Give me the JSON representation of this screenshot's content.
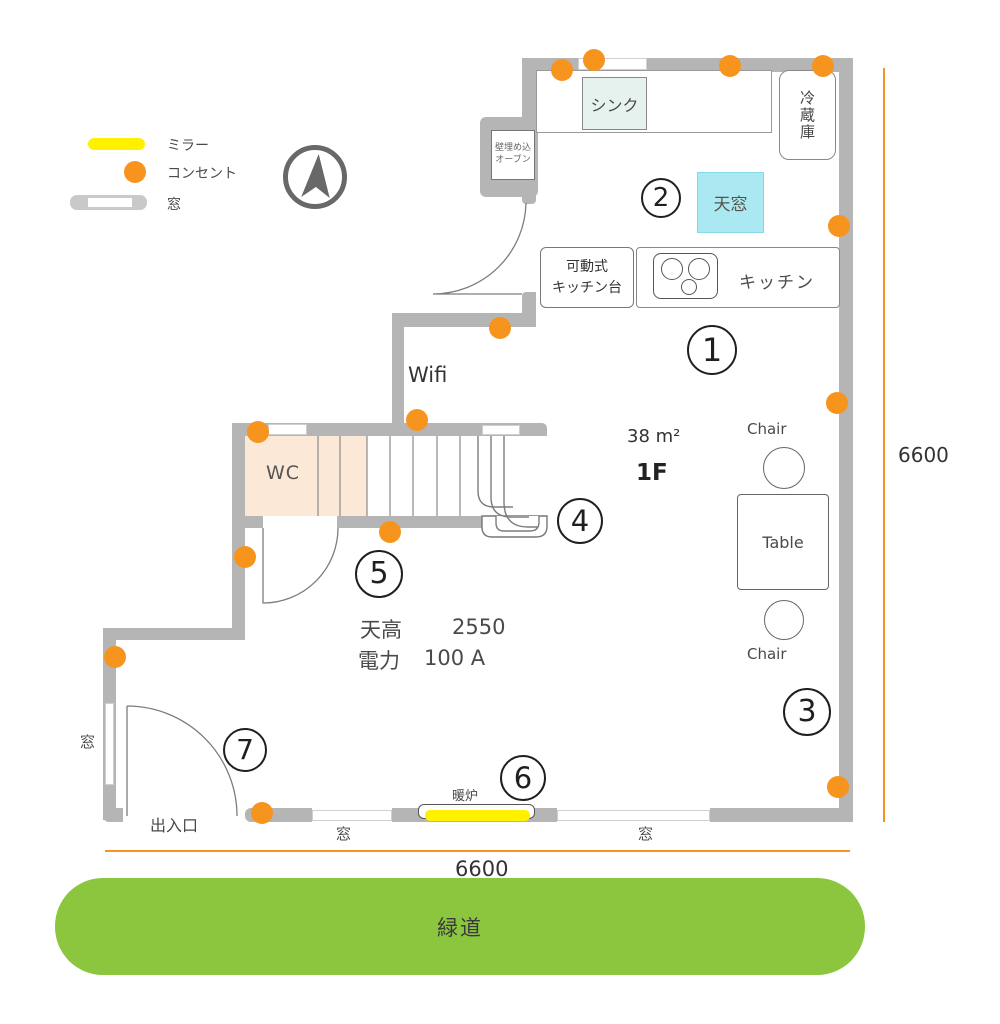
{
  "colors": {
    "orange": "#F7941E",
    "yellow": "#FFF100",
    "wall": "#B5B5B5",
    "green": "#8CC63F",
    "peach": "#FBE8D6",
    "cyan": "#ABE9F2",
    "sink": "#E6F2EE"
  },
  "legend": {
    "mirror_label": "ミラー",
    "outlet_label": "コンセント",
    "window_label": "窓"
  },
  "plan": {
    "floor": "1F",
    "area": "38 m²",
    "wifi": "Wifi",
    "ceiling_label": "天高",
    "ceiling_value": "2550",
    "power_label": "電力",
    "power_value": "100 A",
    "rooms": {
      "sink": "シンク",
      "oven_line1": "壁埋め込",
      "oven_line2": "オーブン",
      "fridge": "冷蔵庫",
      "skylight": "天窓",
      "kitchen": "キッチン",
      "mobile_counter_line1": "可動式",
      "mobile_counter_line2": "キッチン台",
      "wc": "WC",
      "table": "Table",
      "chair_top": "Chair",
      "chair_bottom": "Chair",
      "fireplace": "暖炉",
      "entrance": "出入口",
      "window_left": "窓",
      "window_bottom_left": "窓",
      "window_bottom_right": "窓",
      "greenway": "緑道"
    },
    "markers": [
      "1",
      "2",
      "3",
      "4",
      "5",
      "6",
      "7"
    ],
    "dimensions": {
      "right": "6600",
      "bottom": "6600"
    }
  }
}
